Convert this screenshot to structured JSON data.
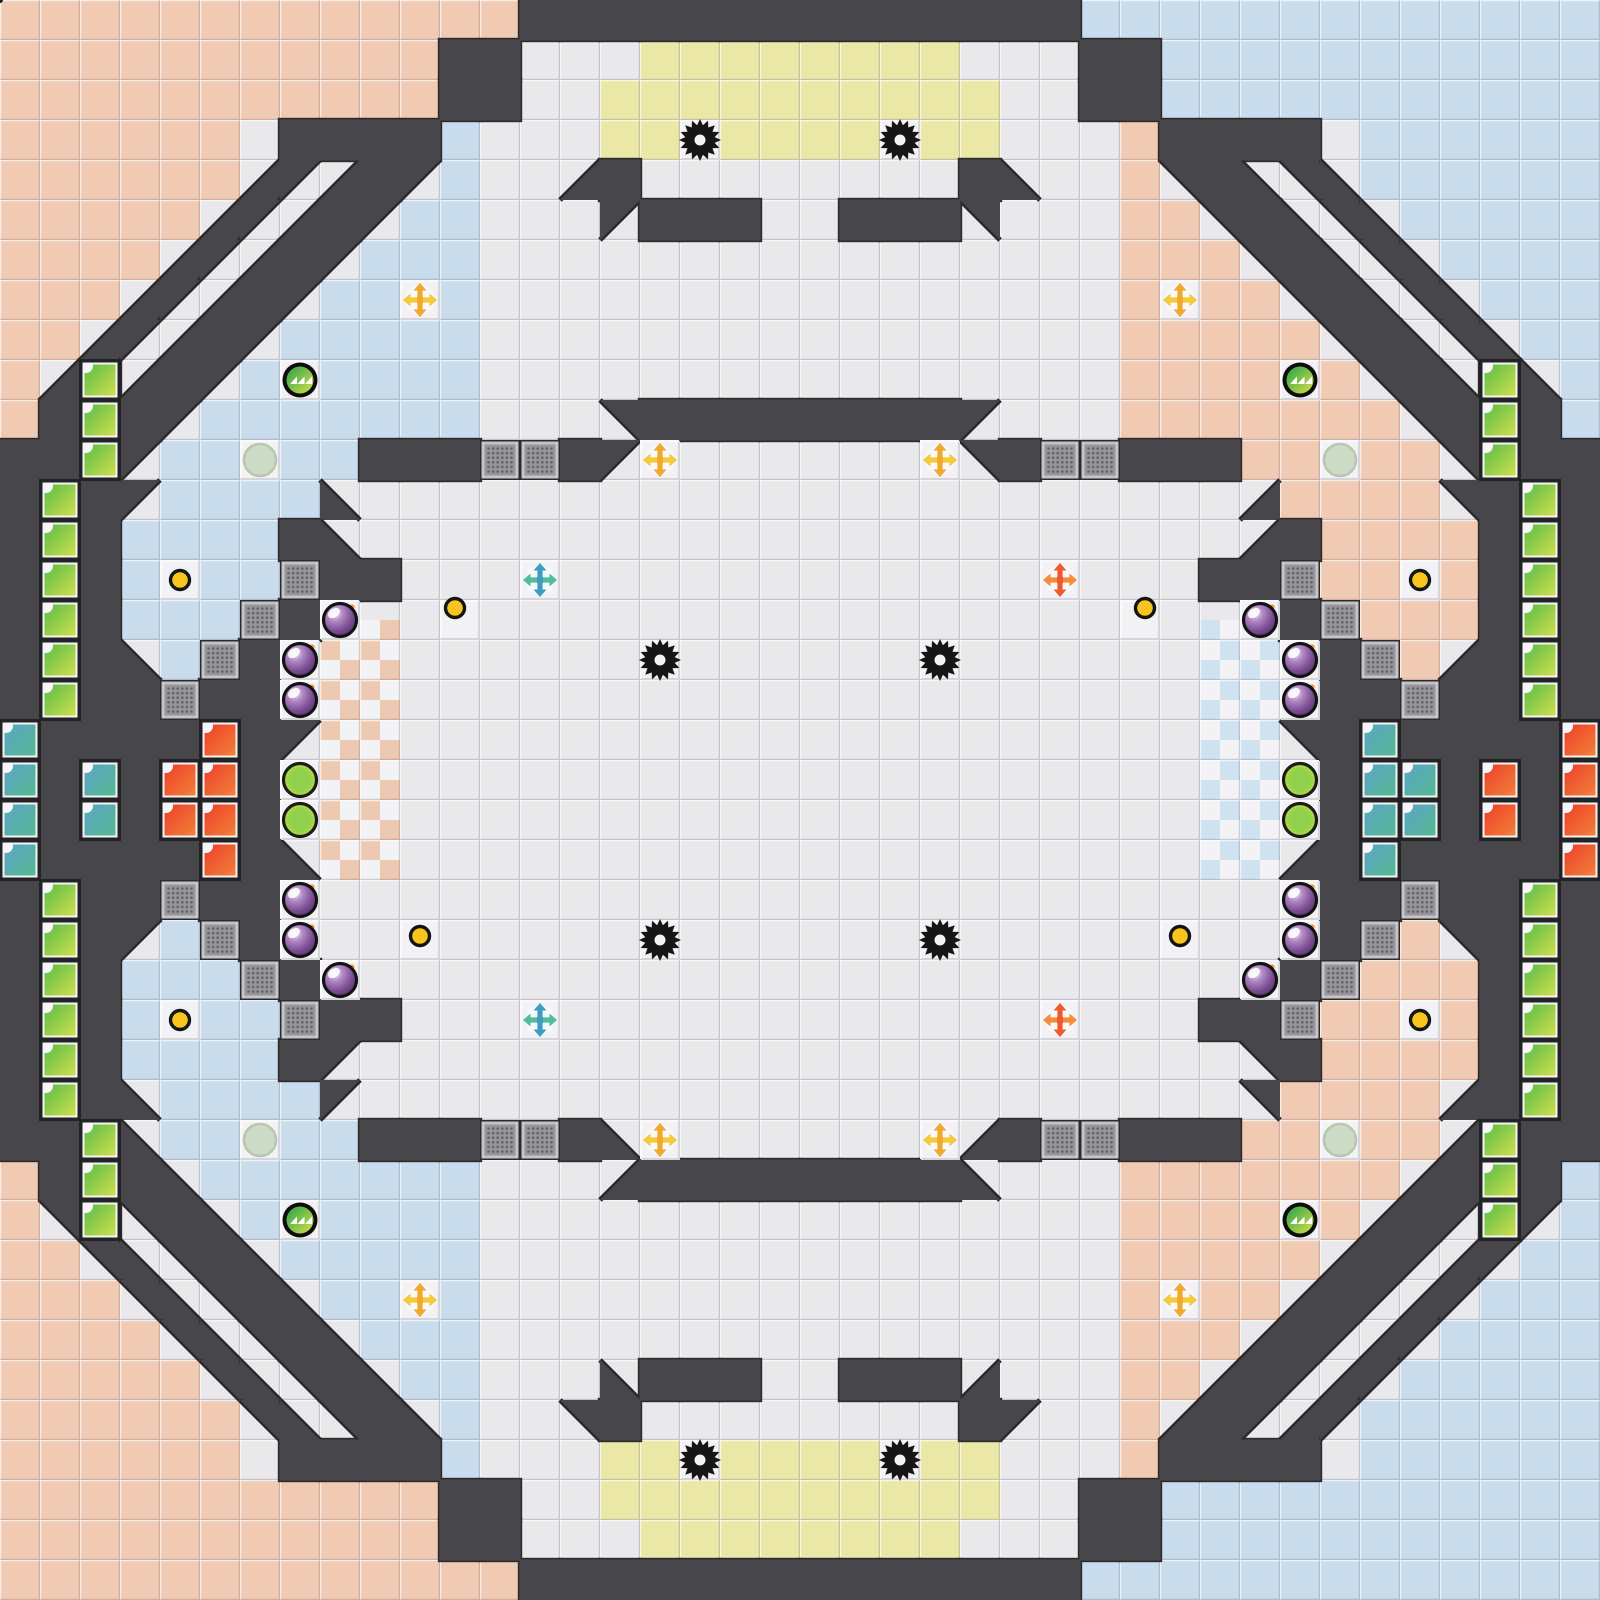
{
  "meta": {
    "app": "tile-arena-game-map",
    "view": "full-map-overview",
    "visible_text": [],
    "grid": {
      "tile_size": 40,
      "cols": 40,
      "rows": 40,
      "width_px": 1600,
      "height_px": 1600
    }
  },
  "colors": {
    "floor": "#e9e9ec",
    "white_tile": "#f2f2f4",
    "salmon": "#f1cab4",
    "blue": "#c8dcec",
    "yellow": "#eae7a7",
    "wall": "#47474b",
    "wall_outline": "#2b2b2e",
    "bevel_light": "rgba(255,255,255,0.65)",
    "bevel_dark": "rgba(122,122,140,0.33)",
    "checker_base": "#f3f3f5",
    "checker_salmon": "#eec9b2",
    "checker_blue": "#cfe2f0",
    "gate_frame": "#c4c4c8",
    "gate_inner": "#95959a",
    "gate_dots": "#62626a",
    "spike": "#161616",
    "bomb_ring": "#131313",
    "bomb_spark": "#f49423",
    "button_fill": "#f7c51e",
    "flag_yellow": "#f4d516",
    "boost_yellow_v": "#f0a929",
    "boost_yellow_h": "#f6c93a",
    "boost_teal_v": "#3e9dc2",
    "boost_teal_h": "#4fbd9a",
    "boost_orange_v": "#ee5a2c",
    "boost_orange_h": "#f58a3a",
    "tile_teal_a": "#5ba4c8",
    "tile_teal_b": "#55b890",
    "tile_red_a": "#ee3e2a",
    "tile_red_b": "#f28038",
    "tile_green_a": "#58bb48",
    "tile_green_b": "#cfe04d",
    "powerup_a": "#28a24b",
    "powerup_b": "#d8e049",
    "lime_outer": "#dde23d",
    "lime_inner": "#8fd24a",
    "pale_fill": "#cdddc5",
    "pale_ring": "#b7c7b1"
  },
  "map": {
    "legend": {
      "s": "salmon-tile",
      "b": "blue-tile",
      "y": "yellow-tile",
      "w": "white-tile",
      ".": "base-floor",
      "#": "wall",
      "G": "gate-tile",
      "1": "wall-triangle-nw",
      "2": "wall-triangle-ne",
      "3": "wall-triangle-se",
      "4": "wall-triangle-sw"
    },
    "symmetry": {
      "note": "quadrant = top-left 20x20; right half mirrored with salmon/blue swap; bottom half mirrored vertically",
      "swap_x": {
        "s": "b",
        "b": "s",
        "1": "2",
        "2": "1",
        "3": "4",
        "4": "3"
      },
      "swap_y": {
        "1": "4",
        "4": "1",
        "2": "3",
        "3": "2"
      }
    },
    "quadrant": [
      "sssssssssssss#######",
      "sssssssssss##...yyyy",
      "sssssssssss##..yyyyy",
      "ssssss.####b...yywyy",
      "ssssss313#1b..3#....",
      "sssss313#1bb...1###.",
      "ssss313#1bbb........",
      "sss313#1bbwb........",
      "ss313#1bbbbb........",
      "s3#3#1bwbbbb........",
      "s###1bbbbbbb...2####",
      "###1bbwbb###GG#1....",
      "###1bbbb4...........",
      "###bbbb#4...........",
      "###bwbbG##..........",
      "###bbbG#w...........",
      "###4bG#w............",
      "####G##w............",
      "#######1............",
      "#######w............"
    ]
  },
  "checker_regions": [
    {
      "x": 320,
      "y": 620,
      "w": 80,
      "h": 260,
      "square": 20,
      "color_key": "checker_salmon",
      "phase": 1
    },
    {
      "x": 1200,
      "y": 620,
      "w": 80,
      "h": 260,
      "square": 20,
      "color_key": "checker_blue",
      "phase": 0
    }
  ],
  "niche_tiles": [
    {
      "color": "green",
      "cells": [
        [
          2,
          9
        ],
        [
          2,
          10
        ],
        [
          2,
          11
        ],
        [
          1,
          12
        ],
        [
          1,
          13
        ],
        [
          1,
          14
        ],
        [
          1,
          15
        ],
        [
          1,
          16
        ],
        [
          1,
          17
        ],
        [
          1,
          22
        ],
        [
          1,
          23
        ],
        [
          1,
          24
        ],
        [
          1,
          25
        ],
        [
          1,
          26
        ],
        [
          1,
          27
        ],
        [
          2,
          28
        ],
        [
          2,
          29
        ],
        [
          2,
          30
        ],
        [
          37,
          9
        ],
        [
          37,
          10
        ],
        [
          37,
          11
        ],
        [
          38,
          12
        ],
        [
          38,
          13
        ],
        [
          38,
          14
        ],
        [
          38,
          15
        ],
        [
          38,
          16
        ],
        [
          38,
          17
        ],
        [
          38,
          22
        ],
        [
          38,
          23
        ],
        [
          38,
          24
        ],
        [
          38,
          25
        ],
        [
          38,
          26
        ],
        [
          38,
          27
        ],
        [
          37,
          28
        ],
        [
          37,
          29
        ],
        [
          37,
          30
        ]
      ]
    },
    {
      "color": "teal",
      "cells": [
        [
          0,
          18
        ],
        [
          0,
          19
        ],
        [
          0,
          20
        ],
        [
          0,
          21
        ],
        [
          2,
          19
        ],
        [
          2,
          20
        ],
        [
          34,
          18
        ],
        [
          34,
          19
        ],
        [
          34,
          20
        ],
        [
          34,
          21
        ],
        [
          35,
          19
        ],
        [
          35,
          20
        ]
      ]
    },
    {
      "color": "red",
      "cells": [
        [
          5,
          18
        ],
        [
          5,
          19
        ],
        [
          5,
          20
        ],
        [
          5,
          21
        ],
        [
          4,
          19
        ],
        [
          4,
          20
        ],
        [
          39,
          18
        ],
        [
          39,
          19
        ],
        [
          39,
          20
        ],
        [
          39,
          21
        ],
        [
          37,
          19
        ],
        [
          37,
          20
        ]
      ]
    }
  ],
  "entities": {
    "flag": [
      {
        "x": 800,
        "y": 340,
        "team": "yellow"
      }
    ],
    "spikes": [
      [
        700,
        140
      ],
      [
        900,
        140
      ],
      [
        660,
        660
      ],
      [
        940,
        660
      ],
      [
        660,
        940
      ],
      [
        940,
        940
      ],
      [
        700,
        1460
      ],
      [
        900,
        1460
      ]
    ],
    "bombs": [
      [
        340,
        620
      ],
      [
        300,
        660
      ],
      [
        300,
        700
      ],
      [
        300,
        900
      ],
      [
        300,
        940
      ],
      [
        340,
        980
      ],
      [
        1260,
        620
      ],
      [
        1300,
        660
      ],
      [
        1300,
        700
      ],
      [
        1300,
        900
      ],
      [
        1300,
        940
      ],
      [
        1260,
        980
      ]
    ],
    "boosts_yellow": [
      [
        420,
        300
      ],
      [
        1180,
        300
      ],
      [
        660,
        460
      ],
      [
        940,
        460
      ],
      [
        660,
        1140
      ],
      [
        940,
        1140
      ],
      [
        420,
        1300
      ],
      [
        1180,
        1300
      ]
    ],
    "boosts_teal": [
      [
        540,
        580
      ],
      [
        540,
        1020
      ]
    ],
    "boosts_orange": [
      [
        1060,
        580
      ],
      [
        1060,
        1020
      ]
    ],
    "powerups_green": [
      [
        300,
        380
      ],
      [
        1300,
        380
      ],
      [
        300,
        1220
      ],
      [
        1300,
        1220
      ]
    ],
    "lime_orbs": [
      [
        300,
        780
      ],
      [
        300,
        820
      ],
      [
        1300,
        780
      ],
      [
        1300,
        820
      ]
    ],
    "pale_orbs": [
      [
        260,
        460
      ],
      [
        1340,
        460
      ],
      [
        260,
        1140
      ],
      [
        1340,
        1140
      ]
    ],
    "buttons": [
      [
        180,
        580
      ],
      [
        1420,
        580
      ],
      [
        180,
        1020
      ],
      [
        1420,
        1020
      ],
      [
        455,
        608
      ],
      [
        1145,
        608
      ],
      [
        420,
        936
      ],
      [
        1180,
        936
      ]
    ]
  }
}
